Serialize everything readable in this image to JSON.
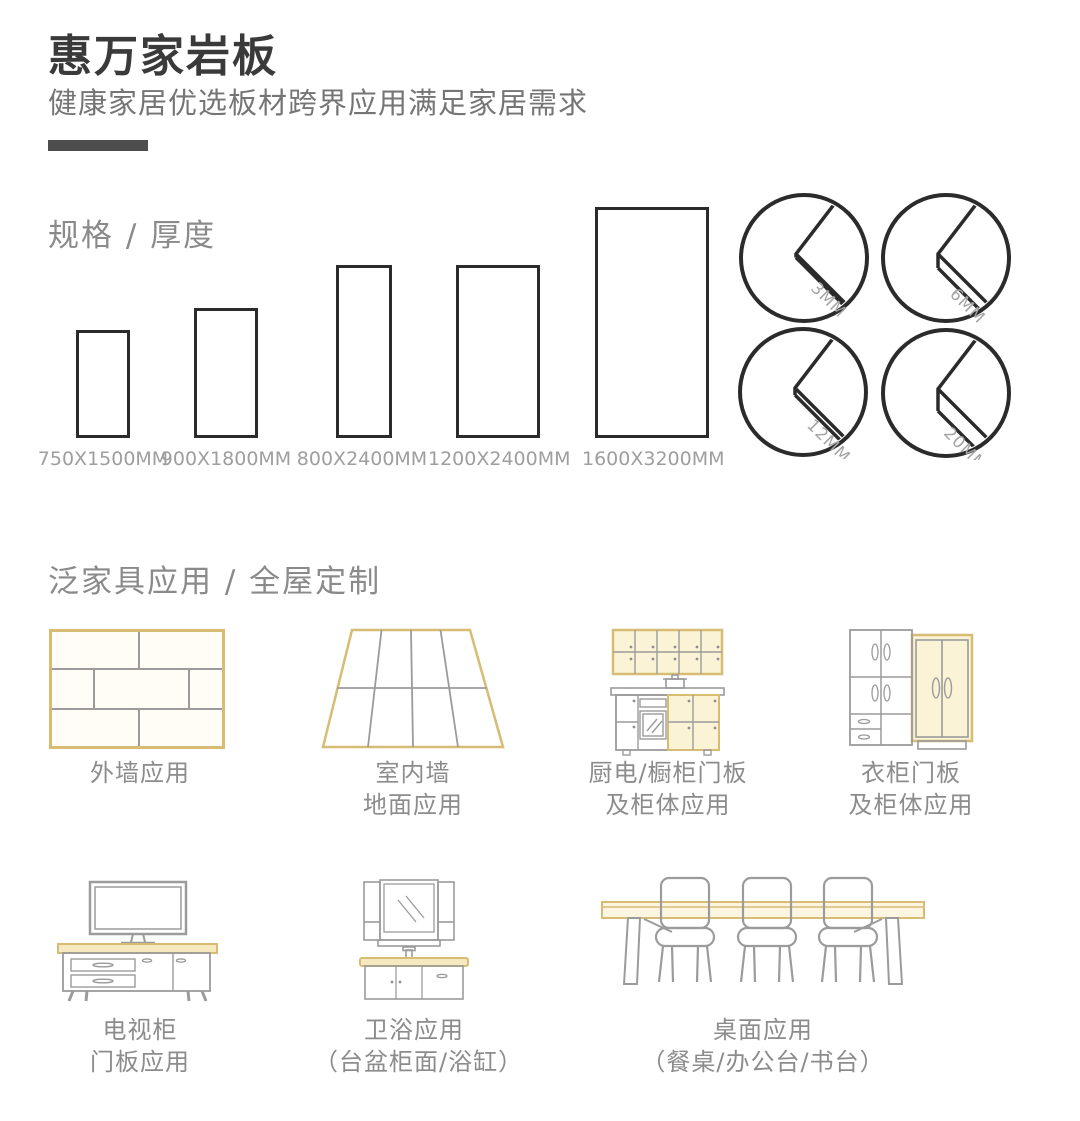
{
  "colors": {
    "accent_yellow": "#d8bc74",
    "line_gray": "#9b9b9b",
    "ink": "#2b2b2b",
    "text_gray": "#8c8c8c"
  },
  "header": {
    "title": "惠万家岩板",
    "subtitle": "健康家居优选板材跨界应用满足家居需求"
  },
  "specs": {
    "heading": "规格 / 厚度",
    "sizes": [
      "750X1500MM",
      "900X1800MM",
      "800X2400MM",
      "1200X2400MM",
      "1600X3200MM"
    ],
    "thicknesses": [
      "3MM",
      "6MM",
      "12MM",
      "20MM"
    ]
  },
  "applications": {
    "heading": "泛家具应用 / 全屋定制",
    "items": [
      {
        "lines": [
          "外墙应用"
        ]
      },
      {
        "lines": [
          "室内墙",
          "地面应用"
        ]
      },
      {
        "lines": [
          "厨电/橱柜门板",
          "及柜体应用"
        ]
      },
      {
        "lines": [
          "衣柜门板",
          "及柜体应用"
        ]
      },
      {
        "lines": [
          "电视柜",
          "门板应用"
        ]
      },
      {
        "lines": [
          "卫浴应用",
          "（台盆柜面/浴缸）"
        ]
      },
      {
        "lines": [
          "桌面应用",
          "（餐桌/办公台/书台）"
        ]
      }
    ]
  }
}
